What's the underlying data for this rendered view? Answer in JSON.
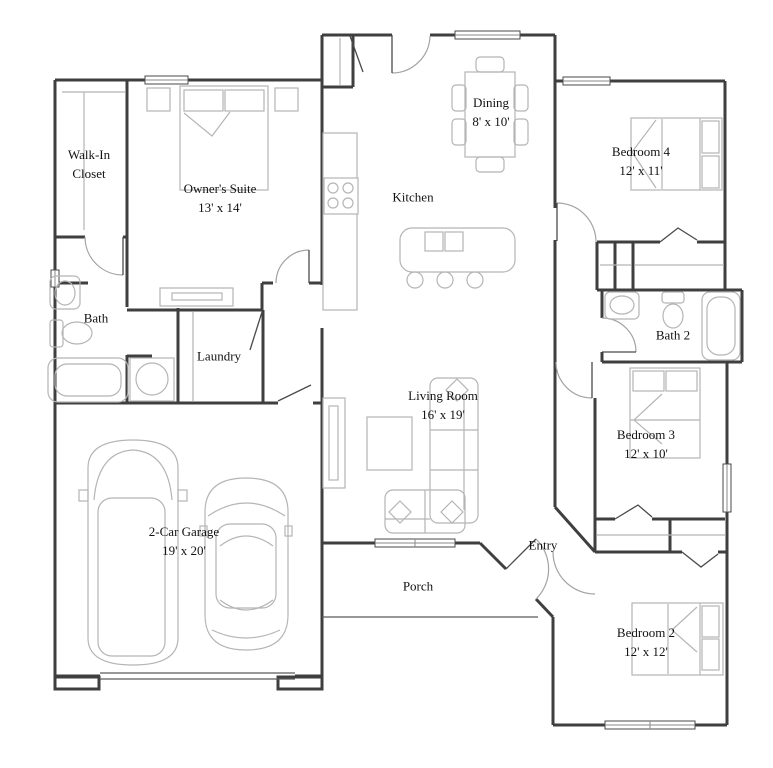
{
  "colors": {
    "wall": "#3f3f3f",
    "furniture": "#b5b5b5",
    "door_arc": "#a3a3a3",
    "text": "#121212",
    "background": "#ffffff"
  },
  "rooms": {
    "walk_in_closet": {
      "label": "Walk-In Closet",
      "dims": ""
    },
    "owners_suite": {
      "label": "Owner's Suite",
      "dims": "13' x 14'"
    },
    "bath": {
      "label": "Bath",
      "dims": ""
    },
    "laundry": {
      "label": "Laundry",
      "dims": ""
    },
    "kitchen": {
      "label": "Kitchen",
      "dims": ""
    },
    "dining": {
      "label": "Dining",
      "dims": "8' x 10'"
    },
    "bedroom4": {
      "label": "Bedroom 4",
      "dims": "12' x 11'"
    },
    "bath2": {
      "label": "Bath 2",
      "dims": ""
    },
    "bedroom3": {
      "label": "Bedroom 3",
      "dims": "12' x 10'"
    },
    "living_room": {
      "label": "Living Room",
      "dims": "16' x 19'"
    },
    "entry": {
      "label": "Entry",
      "dims": ""
    },
    "porch": {
      "label": "Porch",
      "dims": ""
    },
    "garage": {
      "label": "2-Car Garage",
      "dims": "19' x 20'"
    },
    "bedroom2": {
      "label": "Bedroom 2",
      "dims": "12' x 12'"
    }
  },
  "furniture_icons": [
    "bed",
    "nightstand",
    "dresser",
    "dining-table",
    "chair",
    "kitchen-island",
    "stool",
    "stove",
    "counter",
    "refrigerator-counter",
    "sofa-sectional",
    "tv-console",
    "coffee-table",
    "sink",
    "toilet",
    "bathtub",
    "water-heater",
    "car",
    "van",
    "closet-shelf",
    "washer-dryer"
  ]
}
